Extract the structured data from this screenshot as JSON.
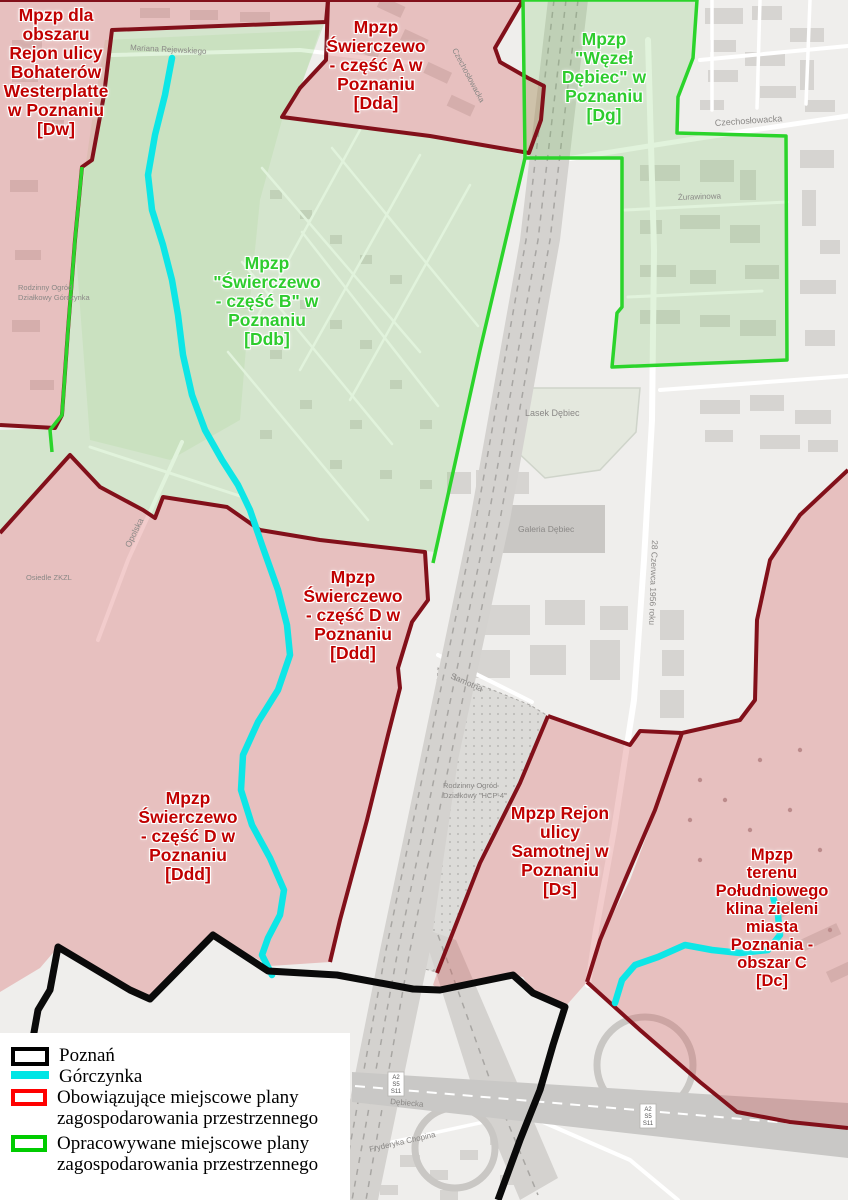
{
  "map": {
    "region": "Poznań - Dębiec / Świerczewo",
    "shield": [
      "A2",
      "S5",
      "S11"
    ],
    "labels": {
      "czechoslowacka": "Czechosłowacka",
      "czechoslowacka2": "Czechosłowacka",
      "czerwca": "28 Czerwca 1956 roku",
      "samotna": "Samotna",
      "opolska": "Opolska",
      "zurawinowa": "Żurawinowa",
      "rejewskiego": "Mariana Rejewskiego",
      "lasek": "Lasek Dębiec",
      "galeria": "Galeria Dębiec",
      "rod_hcp_1": "Rodzinny Ogród",
      "rod_hcp_2": "Działkowy \"HCP-4\"",
      "rod_g_1": "Rodzinny Ogród",
      "rod_g_2": "Działkowy Górczynka",
      "osiedle_zkzl": "Osiedle ZKZL",
      "chopina": "Fryderyka Chopina",
      "debiecka": "Dębiecka"
    }
  },
  "zones": [
    {
      "id": "Dw",
      "status": "existing",
      "lines": [
        "Mpzp dla",
        "obszaru",
        "Rejon ulicy",
        "Bohaterów",
        "Westerplatte",
        "w Poznaniu",
        "[Dw]"
      ]
    },
    {
      "id": "Dda",
      "status": "existing",
      "lines": [
        "Mpzp",
        "Świerczewo",
        "- część A w",
        "Poznaniu",
        "[Dda]"
      ]
    },
    {
      "id": "Dg",
      "status": "proposed",
      "lines": [
        "Mpzp",
        "\"Węzeł",
        "Dębiec\" w",
        "Poznaniu",
        "[Dg]"
      ]
    },
    {
      "id": "Ddb",
      "status": "proposed",
      "lines": [
        "Mpzp",
        "\"Świerczewo",
        "- część B\" w",
        "Poznaniu",
        "[Ddb]"
      ]
    },
    {
      "id": "Ddd",
      "status": "existing",
      "lines": [
        "Mpzp",
        "Świerczewo",
        "- część D w",
        "Poznaniu",
        "[Ddd]"
      ]
    },
    {
      "id": "Ddd",
      "status": "existing",
      "lines": [
        "Mpzp",
        "Świerczewo",
        "- część D w",
        "Poznaniu",
        "[Ddd]"
      ]
    },
    {
      "id": "Ds",
      "status": "existing",
      "lines": [
        "Mpzp Rejon",
        "ulicy",
        "Samotnej w",
        "Poznaniu",
        "[Ds]"
      ]
    },
    {
      "id": "Dc",
      "status": "existing",
      "lines": [
        "Mpzp",
        "terenu",
        "Południowego",
        "klina zieleni",
        "miasta",
        "Poznania -",
        "obszar C",
        "[Dc]"
      ]
    }
  ],
  "legend": {
    "items": [
      {
        "swatch": "black-outline",
        "lines": [
          "Poznań"
        ]
      },
      {
        "swatch": "cyan-line",
        "lines": [
          "Górczynka"
        ]
      },
      {
        "swatch": "red-outline",
        "lines": [
          "Obowiązujące miejscowe plany",
          "zagospodarowania przestrzennego"
        ]
      },
      {
        "swatch": "green-outline",
        "lines": [
          "Opracowywane miejscowe plany",
          "zagospodarowania przestrzennego"
        ]
      }
    ]
  },
  "colors": {
    "existing_border": "#82101a",
    "existing_label": "#c00000",
    "existing_fill": "rgba(213,85,85,0.30)",
    "proposed_border": "#2bd42b",
    "proposed_label": "#2ecc2e",
    "proposed_fill": "rgba(120,200,95,0.22)",
    "stream": "#0de6e6",
    "city_boundary": "#0a0a0a",
    "legend_red": "#ff0000",
    "legend_green": "#00cc00",
    "legend_cyan": "#00e5e5"
  }
}
